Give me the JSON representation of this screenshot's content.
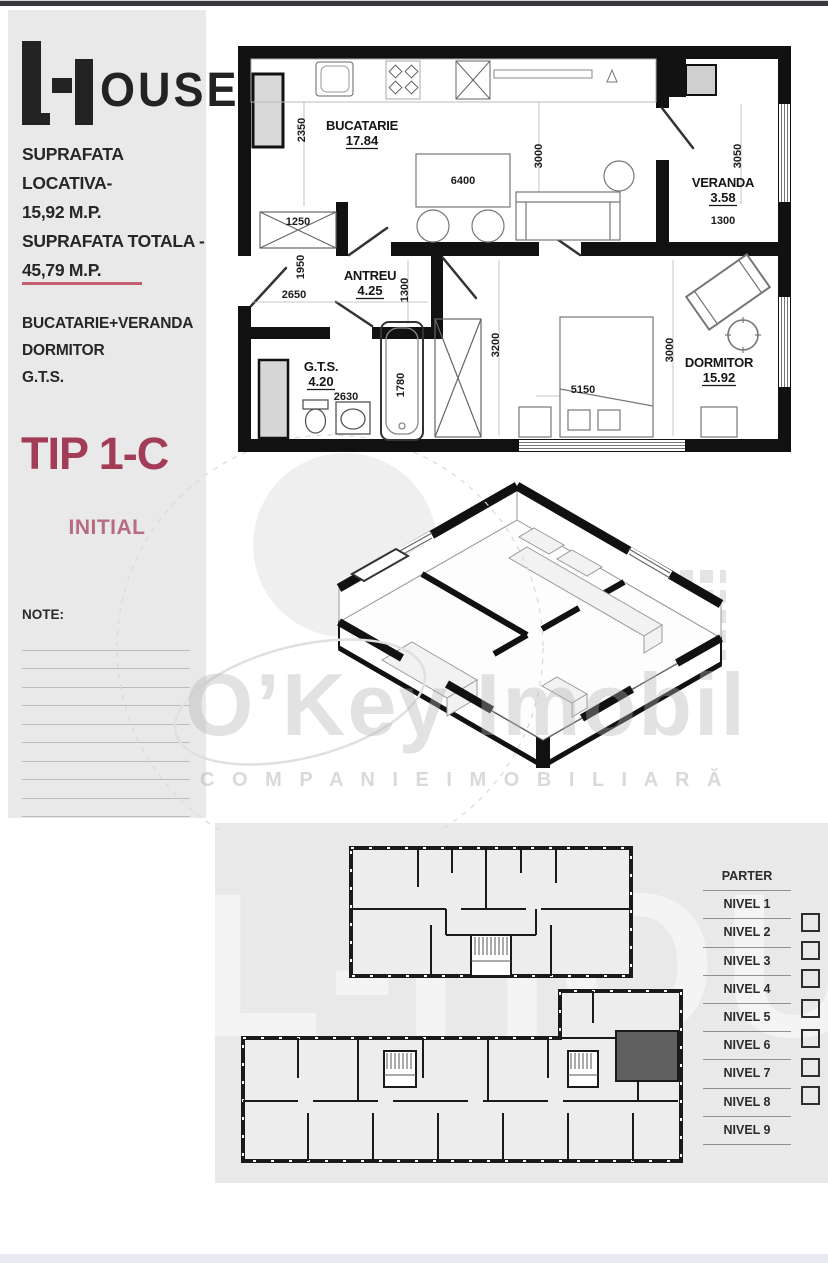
{
  "sidebar": {
    "logo": {
      "name": "L-House",
      "part_rest": "OUSE"
    },
    "area_lines": [
      "SUPRAFATA LOCATIVA-",
      "15,92 M.P.",
      "SUPRAFATA TOTALA -",
      "45,79 M.P."
    ],
    "rooms_summary": [
      "BUCATARIE+VERANDA",
      "DORMITOR",
      "G.T.S."
    ],
    "type_label": "TIP 1-C",
    "status_label": "INITIAL",
    "note_label": "NOTE:"
  },
  "floor_plan": {
    "rooms": [
      {
        "name": "BUCATARIE",
        "area": "17.84"
      },
      {
        "name": "ANTREU",
        "area": "4.25"
      },
      {
        "name": "G.T.S.",
        "area": "4.20"
      },
      {
        "name": "VERANDA",
        "area": "3.58"
      },
      {
        "name": "DORMITOR",
        "area": "15.92"
      }
    ],
    "dimensions": {
      "kitchen_depth": "2350",
      "table_width": "6400",
      "closet_width": "1250",
      "hall_height": "1950",
      "hall_width": "2650",
      "hall_depth": "1300",
      "gts_width": "2630",
      "bath_length": "1780",
      "closet_height": "3200",
      "kitchen_width": "3000",
      "veranda_height": "3050",
      "veranda_width": "1300",
      "bedroom_height": "3000",
      "bed_width": "5150"
    }
  },
  "watermark": {
    "brand": "O’Key Imobil",
    "tagline": "C O M P A N I E   I M O B I L I A R Ă",
    "house": "L-HOUSE"
  },
  "levels_panel": {
    "levels": [
      "PARTER",
      "NIVEL 1",
      "NIVEL 2",
      "NIVEL 3",
      "NIVEL 4",
      "NIVEL 5",
      "NIVEL 6",
      "NIVEL 7",
      "NIVEL 8",
      "NIVEL 9"
    ],
    "checkbox_count": 7
  },
  "colors": {
    "accent": "#a23c57",
    "accent_light": "#b66c81",
    "divider": "#c4606f",
    "panel_bg": "#e9e9e9",
    "wall": "#111111",
    "highlight_unit": "#5f5f5f"
  }
}
